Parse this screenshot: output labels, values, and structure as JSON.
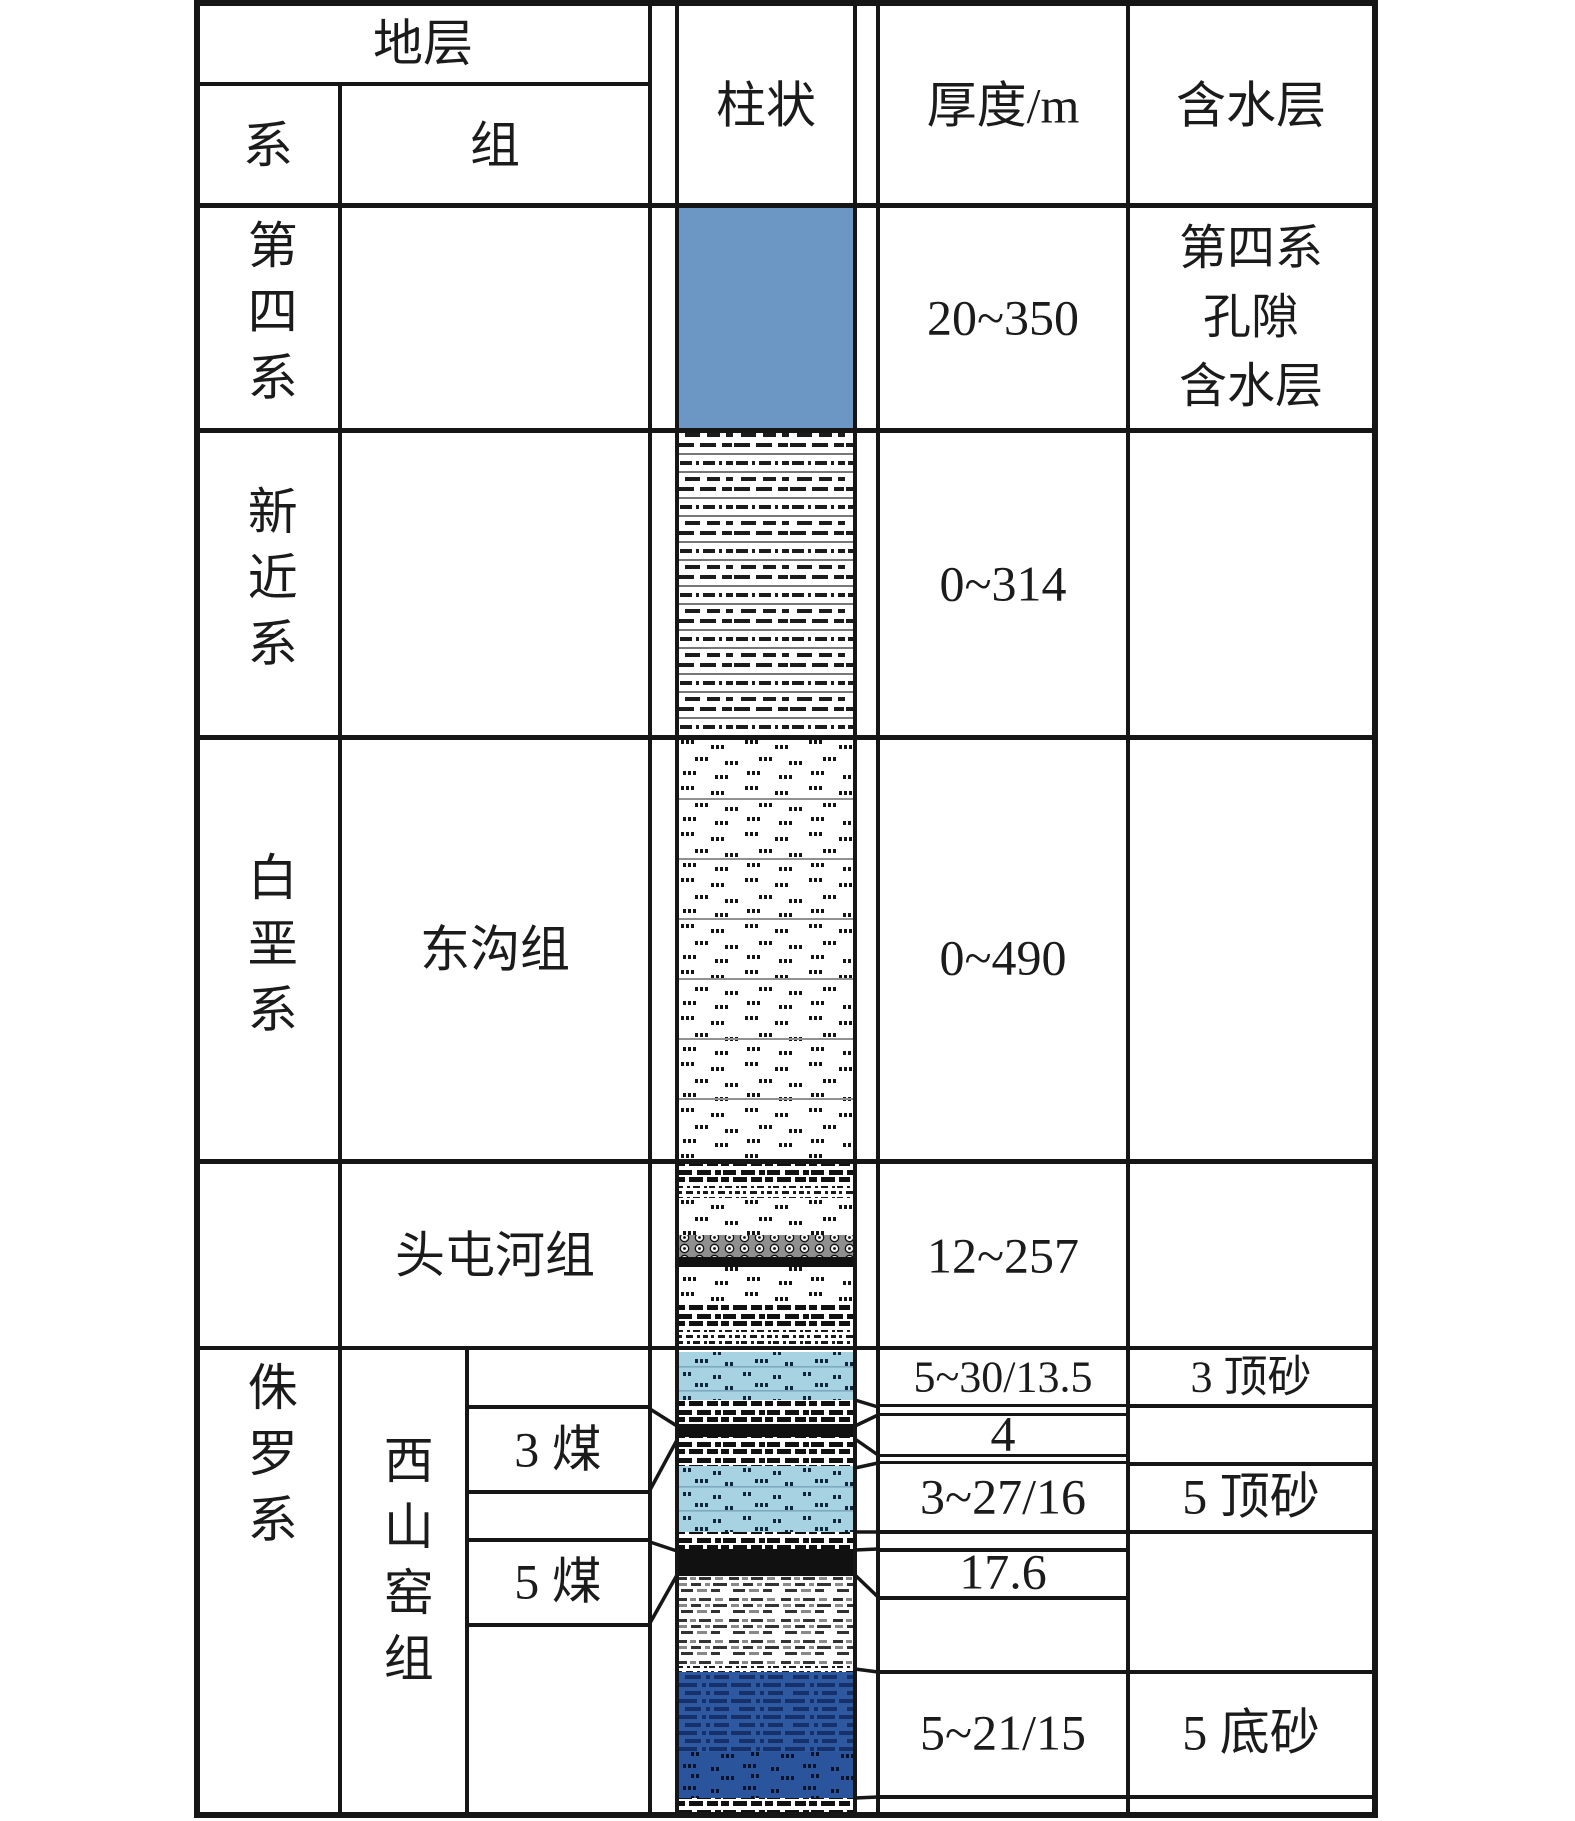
{
  "header": {
    "strata": "地层",
    "system": "系",
    "formation": "组",
    "column": "柱状",
    "thickness": "厚度/m",
    "aquifer": "含水层"
  },
  "systems": {
    "quaternary": "第四系",
    "neogene": "新近系",
    "cretaceous": "白垩系",
    "jurassic": "侏罗系"
  },
  "formations": {
    "donggou": "东沟组",
    "toutunhe": "头屯河组",
    "xishanyao": "西山窑组"
  },
  "coal_seams": {
    "coal3": "3 煤",
    "coal5": "5 煤"
  },
  "thickness_m": {
    "quaternary": "20~350",
    "neogene": "0~314",
    "donggou": "0~490",
    "toutunhe": "12~257",
    "sand3_top": "5~30/13.5",
    "coal3_interval": "4",
    "sand5_top": "3~27/16",
    "coal5": "17.6",
    "sand5_bottom": "5~21/15"
  },
  "aquifers": {
    "quaternary_lines": [
      "第四系",
      "孔隙",
      "含水层"
    ],
    "sand3_top": "3 顶砂",
    "sand5_top": "5 顶砂",
    "sand5_bottom": "5 底砂"
  },
  "lithology_colors": {
    "quaternary_blue": "#6c96c4",
    "sand_light_blue": "#a6d2e2",
    "sand_dark_blue": "#2e58a0",
    "coal_black": "#111111",
    "line_black": "#161616"
  }
}
